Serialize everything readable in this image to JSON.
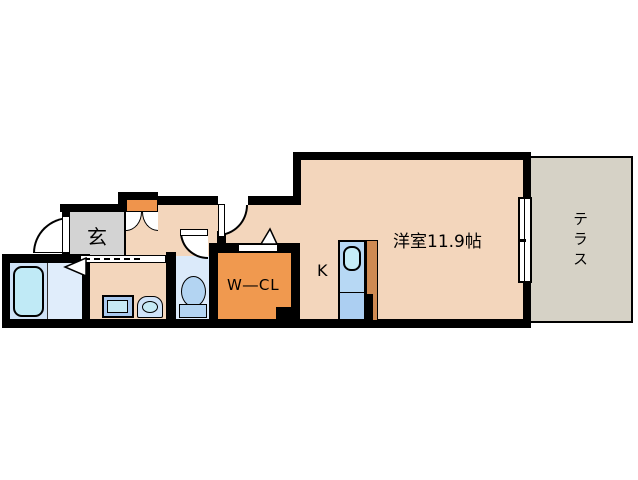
{
  "floorplan": {
    "labels": {
      "main_room": "洋室11.9帖",
      "kitchen": "K",
      "entrance": "玄",
      "walk_in_closet": "W―CL",
      "terrace": "テラス"
    },
    "colors": {
      "wall": "#000000",
      "room_floor": "#f3d6bc",
      "entrance_floor": "#d3d3d3",
      "closet_floor": "#f0994f",
      "terrace_floor": "#d6d2c6",
      "bathroom_floor": "#cfe2f6",
      "toilet_floor": "#dbeafa",
      "fixture_blue": "#aac9ee",
      "fixture_cyan": "#c6e9f4",
      "cabinet_orange": "#ef944c"
    }
  }
}
